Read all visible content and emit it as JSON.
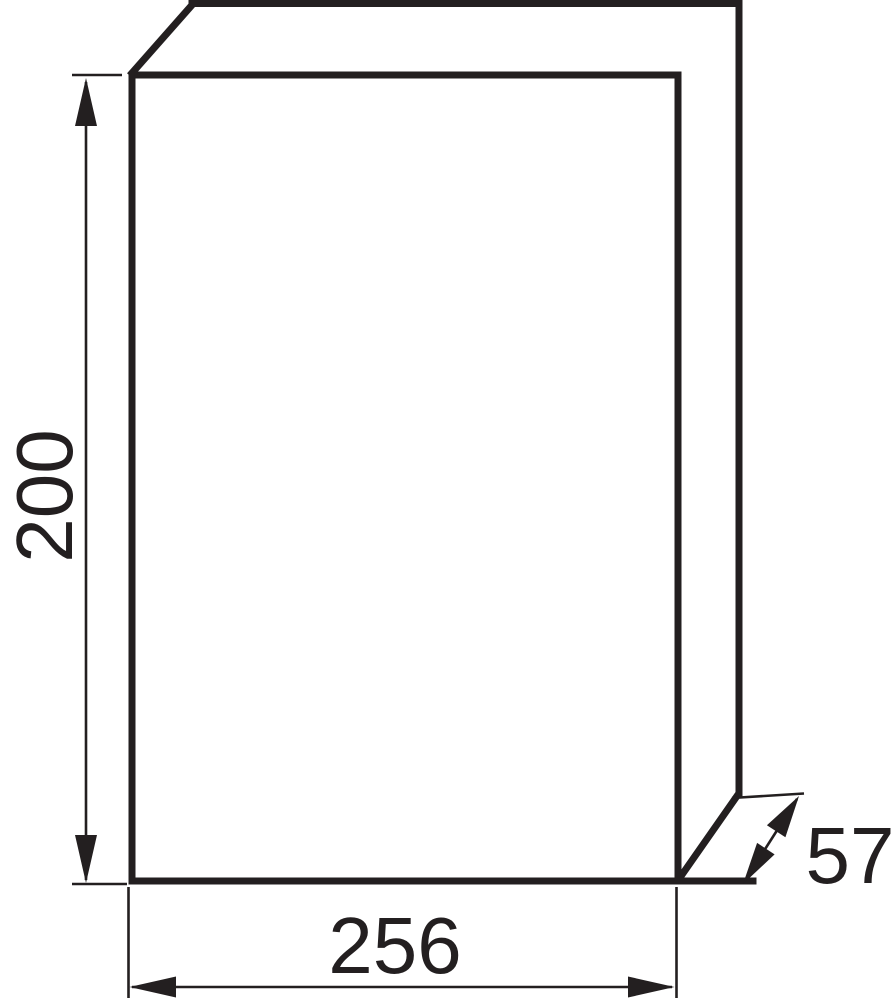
{
  "diagram": {
    "description": "Technical oblique-projection drawing of a rectangular enclosure box with three dimension callouts",
    "line_color": "#231f20",
    "background_color": "#ffffff",
    "dimensions": {
      "height_label": "200",
      "width_label": "256",
      "depth_label": "57"
    }
  }
}
